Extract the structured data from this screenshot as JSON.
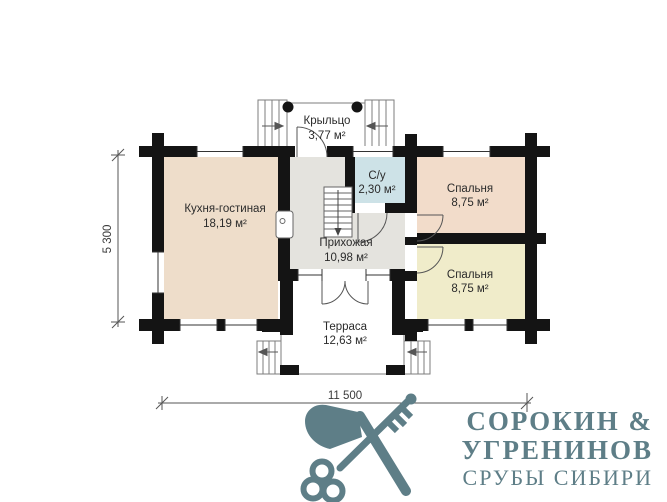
{
  "plan": {
    "rooms": {
      "porch": {
        "name": "Крыльцо",
        "area": "3,77 м²"
      },
      "kitchen": {
        "name": "Кухня-гостиная",
        "area": "18,19 м²"
      },
      "bathroom": {
        "name": "С/у",
        "area": "2,30 м²"
      },
      "bedroom1": {
        "name": "Спальня",
        "area": "8,75 м²"
      },
      "hallway": {
        "name": "Прихожая",
        "area": "10,98 м²"
      },
      "bedroom2": {
        "name": "Спальня",
        "area": "8,75 м²"
      },
      "terrace": {
        "name": "Терраса",
        "area": "12,63 м²"
      }
    },
    "dimensions": {
      "horizontal": "11 500",
      "vertical": "5 300"
    },
    "colors": {
      "kitchen": "#eeddca",
      "bedroom1": "#f2dcca",
      "bedroom2": "#f0ecca",
      "bathroom": "#cde2e7",
      "hallway": "#e4e3de",
      "walls": "#141414",
      "logo": "#5e7e87"
    }
  },
  "logo": {
    "line1": "СОРОКИН &",
    "line2": "УГРЕНИНОВ",
    "line3": "СРУБЫ СИБИРИ",
    "icon": "crossed-axe-and-key"
  }
}
